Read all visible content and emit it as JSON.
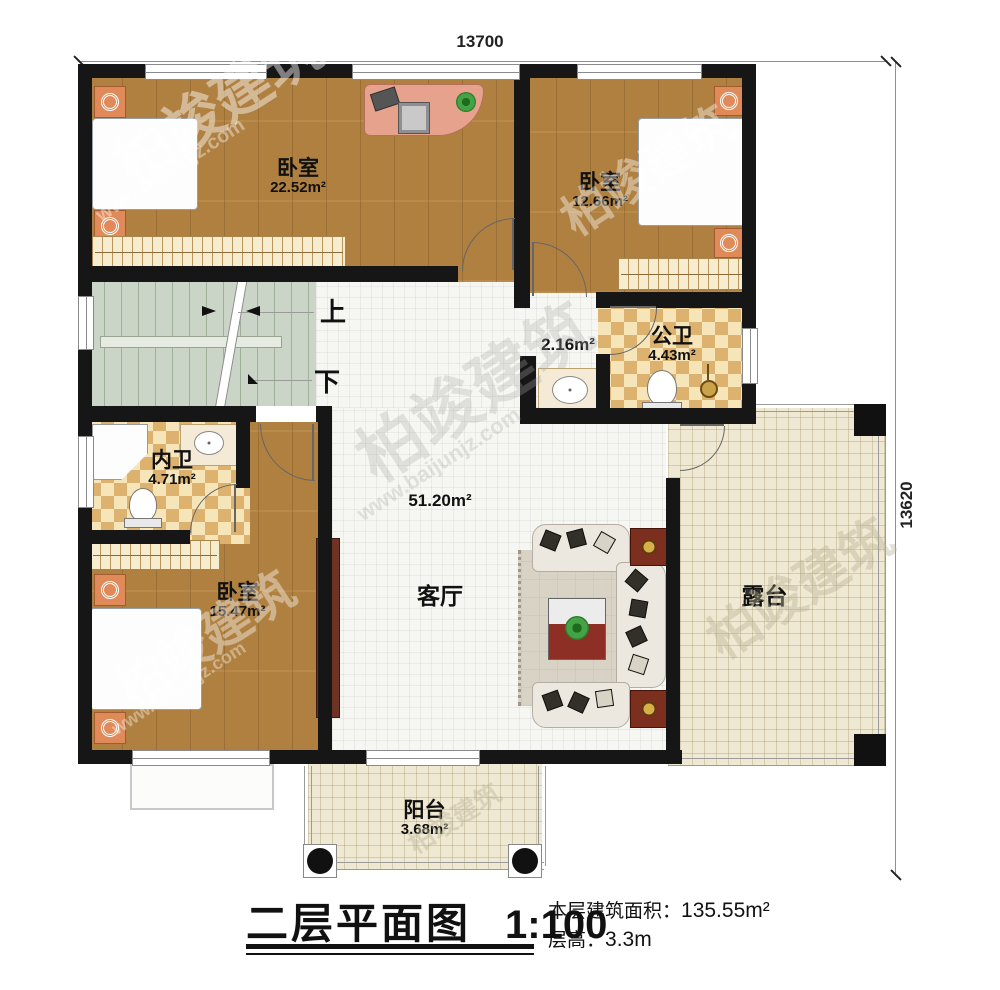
{
  "title_block": {
    "title": "二层平面图",
    "scale": "1:100",
    "area_label": "本层建筑面积：",
    "area_value": "135.55m²",
    "height_label": "层高：",
    "height_value": "3.3m"
  },
  "dimensions": {
    "top": "13700",
    "right": "13620"
  },
  "rooms": {
    "bedroom1": {
      "name": "卧室",
      "area": "22.52m²"
    },
    "bedroom2": {
      "name": "卧室",
      "area": "12.66m²"
    },
    "bedroom3": {
      "name": "卧室",
      "area": "15.47m²"
    },
    "public_bath": {
      "name": "公卫",
      "area": "4.43m²"
    },
    "ensuite_bath": {
      "name": "内卫",
      "area": "4.71m²"
    },
    "living": {
      "name": "客厅",
      "area": "51.20m²"
    },
    "hall": {
      "area": "2.16m²"
    },
    "terrace": {
      "name": "露台"
    },
    "balcony": {
      "name": "阳台",
      "area": "3.68m²"
    }
  },
  "stairs": {
    "up": "上",
    "down": "下"
  },
  "watermark": {
    "brand": "柏竣建筑",
    "url": "www.baijunjz.com"
  },
  "colors": {
    "wall": "#161616",
    "wood_floor": "#b08040",
    "bath_tile": "#ddb26f",
    "stair_floor": "#cbd5c7",
    "terrace_tile": "#efe8d2",
    "bed_blue": "#79c4de"
  }
}
